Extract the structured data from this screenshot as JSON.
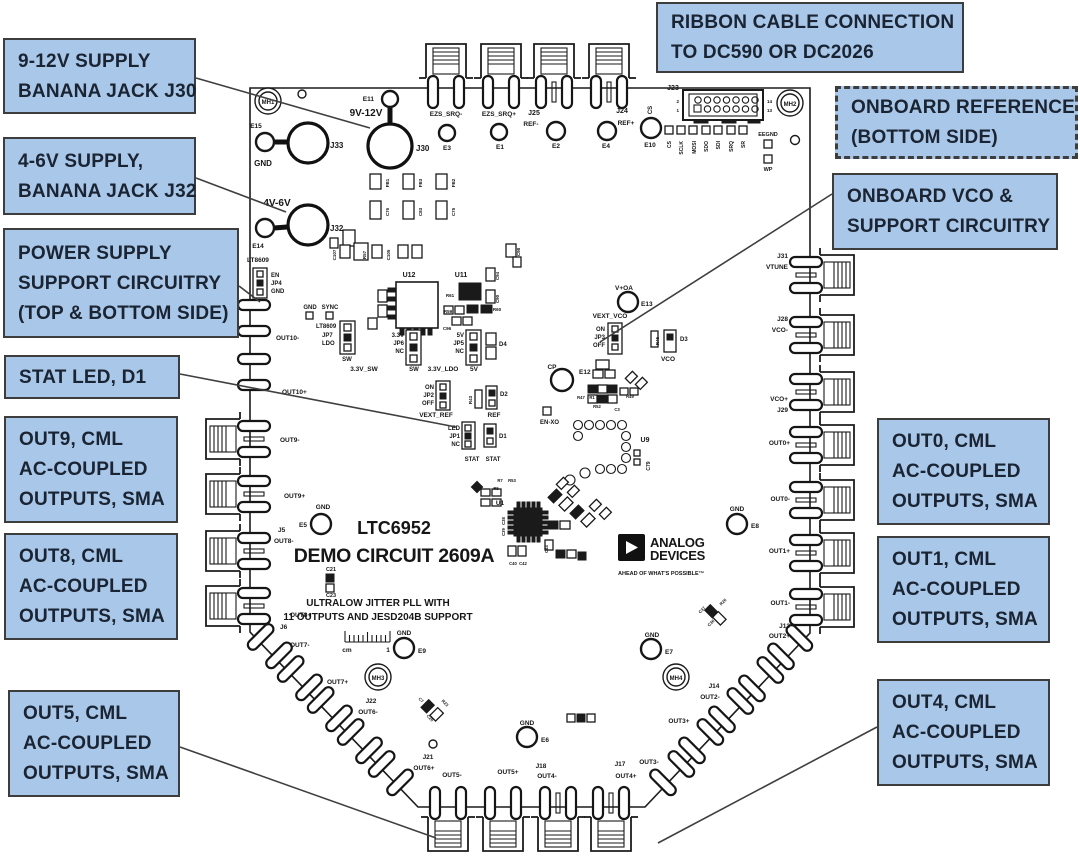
{
  "colors": {
    "callout_fill": "#a9c7e8",
    "callout_border": "#3d3d3d",
    "callout_text": "#1a2433",
    "silkscreen": "#161616"
  },
  "callouts": {
    "supply9": {
      "lines": [
        "9-12V SUPPLY",
        "BANANA JACK J30"
      ]
    },
    "supply4": {
      "lines": [
        "4-6V SUPPLY,",
        "BANANA JACK J32"
      ]
    },
    "psupport": {
      "lines": [
        "POWER SUPPLY",
        "SUPPORT CIRCUITRY",
        "(TOP & BOTTOM SIDE)"
      ]
    },
    "statled": {
      "lines": [
        "STAT LED, D1"
      ]
    },
    "out9": {
      "lines": [
        "OUT9, CML",
        "AC-COUPLED",
        "OUTPUTS, SMA"
      ]
    },
    "out8": {
      "lines": [
        "OUT8, CML",
        "AC-COUPLED",
        "OUTPUTS, SMA"
      ]
    },
    "out5": {
      "lines": [
        "OUT5, CML",
        "AC-COUPLED",
        "OUTPUTS, SMA"
      ]
    },
    "ribbon": {
      "lines": [
        "RIBBON CABLE CONNECTION",
        "TO DC590 OR DC2026"
      ]
    },
    "onref": {
      "lines": [
        "ONBOARD REFERENCE",
        "(BOTTOM SIDE)"
      ]
    },
    "onvco": {
      "lines": [
        "ONBOARD VCO &",
        "SUPPORT CIRCUITRY"
      ]
    },
    "out0": {
      "lines": [
        "OUT0, CML",
        "AC-COUPLED",
        "OUTPUTS, SMA"
      ]
    },
    "out1": {
      "lines": [
        "OUT1, CML",
        "AC-COUPLED",
        "OUTPUTS, SMA"
      ]
    },
    "out4": {
      "lines": [
        "OUT4, CML",
        "AC-COUPLED",
        "OUTPUTS, SMA"
      ]
    }
  },
  "board": {
    "title_line1": "LTC6952",
    "title_line2": "DEMO CIRCUIT 2609A",
    "subtitle_line1": "ULTRALOW JITTER PLL WITH",
    "subtitle_line2": "11 OUTPUTS AND JESD204B SUPPORT",
    "ruler_unit": "cm",
    "ruler_mark": "1",
    "logo": {
      "line1": "ANALOG",
      "line2": "DEVICES",
      "tagline": "AHEAD OF WHAT'S POSSIBLE™"
    },
    "labels": [
      {
        "t": "MH1",
        "x": 268,
        "y": 104,
        "s": 6
      },
      {
        "t": "MH2",
        "x": 790,
        "y": 106,
        "s": 6
      },
      {
        "t": "MH3",
        "x": 378,
        "y": 680,
        "s": 6
      },
      {
        "t": "MH4",
        "x": 676,
        "y": 680,
        "s": 6
      },
      {
        "t": "E15",
        "x": 256,
        "y": 128,
        "s": 6.5
      },
      {
        "t": "GND",
        "x": 263,
        "y": 166,
        "s": 8
      },
      {
        "t": "J33",
        "x": 330,
        "y": 148,
        "s": 8,
        "a": "start"
      },
      {
        "t": "E11",
        "x": 374,
        "y": 101,
        "s": 6.5,
        "a": "end"
      },
      {
        "t": "9V-12V",
        "x": 366,
        "y": 116,
        "s": 10
      },
      {
        "t": "J30",
        "x": 416,
        "y": 151,
        "s": 8,
        "a": "start"
      },
      {
        "t": "4V-6V",
        "x": 277,
        "y": 206,
        "s": 10
      },
      {
        "t": "E14",
        "x": 258,
        "y": 248,
        "s": 6.5
      },
      {
        "t": "J32",
        "x": 330,
        "y": 231,
        "s": 8,
        "a": "start"
      },
      {
        "t": "EZS_SRQ-",
        "x": 446,
        "y": 116,
        "s": 6.5
      },
      {
        "t": "E3",
        "x": 447,
        "y": 150,
        "s": 6.5
      },
      {
        "t": "EZS_SRQ+",
        "x": 499,
        "y": 116,
        "s": 6.5
      },
      {
        "t": "E1",
        "x": 500,
        "y": 149,
        "s": 6.5
      },
      {
        "t": "J25",
        "x": 534,
        "y": 115,
        "s": 7
      },
      {
        "t": "REF-",
        "x": 531,
        "y": 126,
        "s": 6.5
      },
      {
        "t": "E2",
        "x": 556,
        "y": 148,
        "s": 6.5
      },
      {
        "t": "J24",
        "x": 622,
        "y": 113,
        "s": 7
      },
      {
        "t": "REF+",
        "x": 626,
        "y": 125,
        "s": 6.5
      },
      {
        "t": "E4",
        "x": 606,
        "y": 148,
        "s": 6.5
      },
      {
        "t": "CS",
        "x": 652,
        "y": 110,
        "s": 6,
        "r": -90
      },
      {
        "t": "E10",
        "x": 650,
        "y": 147,
        "s": 6.5
      },
      {
        "t": "J23",
        "x": 673,
        "y": 90,
        "s": 7
      },
      {
        "t": "2",
        "x": 679,
        "y": 103,
        "s": 4.5,
        "a": "end"
      },
      {
        "t": "1",
        "x": 679,
        "y": 112,
        "s": 4.5,
        "a": "end"
      },
      {
        "t": "14",
        "x": 767,
        "y": 103,
        "s": 4.5,
        "a": "start"
      },
      {
        "t": "13",
        "x": 767,
        "y": 112,
        "s": 4.5,
        "a": "start"
      },
      {
        "t": "CS",
        "x": 671,
        "y": 141,
        "s": 5,
        "r": -90,
        "a": "end"
      },
      {
        "t": "SCLK",
        "x": 683,
        "y": 141,
        "s": 5,
        "r": -90,
        "a": "end"
      },
      {
        "t": "MOSI",
        "x": 696,
        "y": 141,
        "s": 5,
        "r": -90,
        "a": "end"
      },
      {
        "t": "SDO",
        "x": 708,
        "y": 141,
        "s": 5,
        "r": -90,
        "a": "end"
      },
      {
        "t": "SDI",
        "x": 720,
        "y": 141,
        "s": 5,
        "r": -90,
        "a": "end"
      },
      {
        "t": "SRQ",
        "x": 733,
        "y": 141,
        "s": 5,
        "r": -90,
        "a": "end"
      },
      {
        "t": "SR",
        "x": 745,
        "y": 141,
        "s": 5,
        "r": -90,
        "a": "end"
      },
      {
        "t": "EEGND",
        "x": 768,
        "y": 136,
        "s": 5.5
      },
      {
        "t": "WP",
        "x": 768,
        "y": 171,
        "s": 5.5
      },
      {
        "t": "FB1",
        "x": 389,
        "y": 183,
        "s": 4.5,
        "r": -90
      },
      {
        "t": "C76",
        "x": 389,
        "y": 212,
        "s": 4.5,
        "r": -90
      },
      {
        "t": "FB3",
        "x": 422,
        "y": 183,
        "s": 4.5,
        "r": -90
      },
      {
        "t": "C83",
        "x": 422,
        "y": 212,
        "s": 4.5,
        "r": -90
      },
      {
        "t": "FB2",
        "x": 455,
        "y": 183,
        "s": 4.5,
        "r": -90
      },
      {
        "t": "C75",
        "x": 455,
        "y": 212,
        "s": 4.5,
        "r": -90
      },
      {
        "t": "C107",
        "x": 336,
        "y": 255,
        "s": 4.5,
        "r": -90
      },
      {
        "t": "R57",
        "x": 366,
        "y": 255,
        "s": 4.5,
        "r": -90
      },
      {
        "t": "C105",
        "x": 390,
        "y": 255,
        "s": 4.5,
        "r": -90
      },
      {
        "t": "C98",
        "x": 520,
        "y": 252,
        "s": 4.5,
        "r": -90
      },
      {
        "t": "LT8609",
        "x": 247,
        "y": 262,
        "s": 6.5,
        "a": "start"
      },
      {
        "t": "EN",
        "x": 271,
        "y": 277,
        "s": 6,
        "a": "start"
      },
      {
        "t": "JP4",
        "x": 271,
        "y": 285,
        "s": 6,
        "a": "start"
      },
      {
        "t": "GND",
        "x": 271,
        "y": 293,
        "s": 6,
        "a": "start"
      },
      {
        "t": "GND",
        "x": 310,
        "y": 309,
        "s": 6
      },
      {
        "t": "SYNC",
        "x": 330,
        "y": 309,
        "s": 6
      },
      {
        "t": "U12",
        "x": 409,
        "y": 277,
        "s": 7
      },
      {
        "t": "U11",
        "x": 461,
        "y": 277,
        "s": 7
      },
      {
        "t": "C94",
        "x": 499,
        "y": 276,
        "s": 4.5,
        "r": -90
      },
      {
        "t": "C90",
        "x": 499,
        "y": 299,
        "s": 4.5,
        "r": -90
      },
      {
        "t": "R61",
        "x": 450,
        "y": 297,
        "s": 4.5
      },
      {
        "t": "R59",
        "x": 448,
        "y": 313,
        "s": 4.5
      },
      {
        "t": "R60",
        "x": 497,
        "y": 311,
        "s": 4.5
      },
      {
        "t": "C96",
        "x": 447,
        "y": 330,
        "s": 4.5
      },
      {
        "t": "LT8609",
        "x": 316,
        "y": 328,
        "s": 6,
        "a": "start"
      },
      {
        "t": "JP7",
        "x": 322,
        "y": 337,
        "s": 6,
        "a": "start"
      },
      {
        "t": "LDO",
        "x": 322,
        "y": 345,
        "s": 6,
        "a": "start"
      },
      {
        "t": "SW",
        "x": 347,
        "y": 361,
        "s": 6
      },
      {
        "t": "3.3V_SW",
        "x": 364,
        "y": 371,
        "s": 6.5
      },
      {
        "t": "3.3V",
        "x": 404,
        "y": 337,
        "s": 6,
        "a": "end"
      },
      {
        "t": "JP6",
        "x": 404,
        "y": 345,
        "s": 6,
        "a": "end"
      },
      {
        "t": "NC",
        "x": 404,
        "y": 353,
        "s": 6,
        "a": "end"
      },
      {
        "t": "SW",
        "x": 414,
        "y": 371,
        "s": 6
      },
      {
        "t": "3.3V_LDO",
        "x": 443,
        "y": 371,
        "s": 6.5
      },
      {
        "t": "5V",
        "x": 464,
        "y": 337,
        "s": 6,
        "a": "end"
      },
      {
        "t": "JP5",
        "x": 464,
        "y": 345,
        "s": 6,
        "a": "end"
      },
      {
        "t": "NC",
        "x": 464,
        "y": 353,
        "s": 6,
        "a": "end"
      },
      {
        "t": "5V",
        "x": 474,
        "y": 371,
        "s": 6.5
      },
      {
        "t": "D4",
        "x": 499,
        "y": 346,
        "s": 6,
        "a": "start"
      },
      {
        "t": "ON",
        "x": 434,
        "y": 389,
        "s": 6,
        "a": "end"
      },
      {
        "t": "JP2",
        "x": 434,
        "y": 397,
        "s": 6,
        "a": "end"
      },
      {
        "t": "OFF",
        "x": 434,
        "y": 405,
        "s": 6,
        "a": "end"
      },
      {
        "t": "VEXT_REF",
        "x": 436,
        "y": 417,
        "s": 6.5
      },
      {
        "t": "R43",
        "x": 472,
        "y": 400,
        "s": 4.5,
        "r": -90
      },
      {
        "t": "D2",
        "x": 500,
        "y": 396,
        "s": 6,
        "a": "start"
      },
      {
        "t": "REF",
        "x": 494,
        "y": 417,
        "s": 6.5
      },
      {
        "t": "LED",
        "x": 460,
        "y": 430,
        "s": 6,
        "a": "end"
      },
      {
        "t": "JP1",
        "x": 460,
        "y": 438,
        "s": 6,
        "a": "end"
      },
      {
        "t": "NC",
        "x": 460,
        "y": 446,
        "s": 6,
        "a": "end"
      },
      {
        "t": "D1",
        "x": 499,
        "y": 438,
        "s": 6,
        "a": "start"
      },
      {
        "t": "STAT",
        "x": 472,
        "y": 461,
        "s": 6
      },
      {
        "t": "STAT",
        "x": 493,
        "y": 461,
        "s": 6
      },
      {
        "t": "V+OA",
        "x": 624,
        "y": 290,
        "s": 6.5
      },
      {
        "t": "E13",
        "x": 641,
        "y": 306,
        "s": 6.5,
        "a": "start"
      },
      {
        "t": "VEXT_VCO",
        "x": 610,
        "y": 318,
        "s": 6.5
      },
      {
        "t": "ON",
        "x": 605,
        "y": 331,
        "s": 6,
        "a": "end"
      },
      {
        "t": "JP3",
        "x": 605,
        "y": 339,
        "s": 6,
        "a": "end"
      },
      {
        "t": "OFF",
        "x": 605,
        "y": 347,
        "s": 6,
        "a": "end"
      },
      {
        "t": "R45",
        "x": 659,
        "y": 341,
        "s": 4.5,
        "r": -90
      },
      {
        "t": "D3",
        "x": 680,
        "y": 341,
        "s": 6,
        "a": "start"
      },
      {
        "t": "VCO",
        "x": 668,
        "y": 361,
        "s": 6.5
      },
      {
        "t": "CP",
        "x": 552,
        "y": 369,
        "s": 6.5
      },
      {
        "t": "E12",
        "x": 579,
        "y": 374,
        "s": 6.5,
        "a": "start"
      },
      {
        "t": "R47",
        "x": 581,
        "y": 399,
        "s": 4.2
      },
      {
        "t": "R1",
        "x": 592,
        "y": 399,
        "s": 4.2
      },
      {
        "t": "R51",
        "x": 603,
        "y": 399,
        "s": 4.2
      },
      {
        "t": "R52",
        "x": 597,
        "y": 408,
        "s": 4.2
      },
      {
        "t": "C3",
        "x": 617,
        "y": 411,
        "s": 4.2
      },
      {
        "t": "R49",
        "x": 630,
        "y": 398,
        "s": 4.2
      },
      {
        "t": "EN-XO",
        "x": 540,
        "y": 424,
        "s": 6,
        "a": "start"
      },
      {
        "t": "U9",
        "x": 645,
        "y": 442,
        "s": 7
      },
      {
        "t": "C79",
        "x": 650,
        "y": 466,
        "s": 5,
        "r": -90
      },
      {
        "t": "R7",
        "x": 500,
        "y": 482,
        "s": 4.2
      },
      {
        "t": "R53",
        "x": 512,
        "y": 482,
        "s": 4.2
      },
      {
        "t": "R5",
        "x": 496,
        "y": 490,
        "s": 4.2
      },
      {
        "t": "U1",
        "x": 500,
        "y": 505,
        "s": 6.5
      },
      {
        "t": "C38",
        "x": 505,
        "y": 521,
        "s": 4.2,
        "r": -90
      },
      {
        "t": "C39",
        "x": 505,
        "y": 532,
        "s": 4.2,
        "r": -90
      },
      {
        "t": "C40",
        "x": 513,
        "y": 565,
        "s": 4.2
      },
      {
        "t": "C42",
        "x": 523,
        "y": 565,
        "s": 4.2
      },
      {
        "t": "C44",
        "x": 548,
        "y": 549,
        "s": 4.2,
        "r": -90
      },
      {
        "t": "GND",
        "x": 323,
        "y": 509,
        "s": 6.5
      },
      {
        "t": "E5",
        "x": 307,
        "y": 527,
        "s": 6.5,
        "a": "end"
      },
      {
        "t": "C21",
        "x": 331,
        "y": 571,
        "s": 5.5
      },
      {
        "t": "C23",
        "x": 331,
        "y": 597,
        "s": 5.5
      },
      {
        "t": "GND",
        "x": 404,
        "y": 635,
        "s": 6.5
      },
      {
        "t": "E9",
        "x": 418,
        "y": 653,
        "s": 6.5,
        "a": "start"
      },
      {
        "t": "GND",
        "x": 652,
        "y": 637,
        "s": 6.5
      },
      {
        "t": "E7",
        "x": 665,
        "y": 654,
        "s": 6.5,
        "a": "start"
      },
      {
        "t": "GND",
        "x": 527,
        "y": 725,
        "s": 6.5
      },
      {
        "t": "E6",
        "x": 541,
        "y": 742,
        "s": 6.5,
        "a": "start"
      },
      {
        "t": "GND",
        "x": 737,
        "y": 511,
        "s": 6.5
      },
      {
        "t": "E8",
        "x": 751,
        "y": 528,
        "s": 6.5,
        "a": "start"
      },
      {
        "t": "C36",
        "x": 712,
        "y": 624,
        "s": 4.2,
        "r": -45
      },
      {
        "t": "R26",
        "x": 724,
        "y": 603,
        "s": 4.2,
        "r": -45
      },
      {
        "t": "C37",
        "x": 703,
        "y": 611,
        "s": 4.2,
        "r": -45
      },
      {
        "t": "C7",
        "x": 420,
        "y": 701,
        "s": 4.2,
        "r": 45
      },
      {
        "t": "C28",
        "x": 429,
        "y": 719,
        "s": 4.2,
        "r": 45
      },
      {
        "t": "R23",
        "x": 444,
        "y": 704,
        "s": 4.2,
        "r": 45
      },
      {
        "t": "OUT10-",
        "x": 276,
        "y": 340,
        "s": 6.5,
        "a": "start"
      },
      {
        "t": "OUT10+",
        "x": 282,
        "y": 394,
        "s": 6.5,
        "a": "start"
      },
      {
        "t": "OUT9-",
        "x": 280,
        "y": 442,
        "s": 6.5,
        "a": "start"
      },
      {
        "t": "OUT9+",
        "x": 284,
        "y": 498,
        "s": 6.5,
        "a": "start"
      },
      {
        "t": "J5",
        "x": 278,
        "y": 532,
        "s": 6.5,
        "a": "start"
      },
      {
        "t": "OUT8-",
        "x": 274,
        "y": 543,
        "s": 6.5,
        "a": "start"
      },
      {
        "t": "OUT8+",
        "x": 290,
        "y": 617,
        "s": 6.5,
        "a": "start"
      },
      {
        "t": "J6",
        "x": 280,
        "y": 629,
        "s": 6.5,
        "a": "start"
      },
      {
        "t": "OUT7-",
        "x": 290,
        "y": 647,
        "s": 6.5,
        "a": "start"
      },
      {
        "t": "OUT7+",
        "x": 327,
        "y": 684,
        "s": 6.5,
        "a": "start"
      },
      {
        "t": "J22",
        "x": 371,
        "y": 703,
        "s": 6.5
      },
      {
        "t": "OUT6-",
        "x": 368,
        "y": 714,
        "s": 6.5
      },
      {
        "t": "J21",
        "x": 428,
        "y": 759,
        "s": 6.5
      },
      {
        "t": "OUT6+",
        "x": 424,
        "y": 770,
        "s": 6.5
      },
      {
        "t": "OUT5-",
        "x": 452,
        "y": 777,
        "s": 6.5
      },
      {
        "t": "OUT5+",
        "x": 508,
        "y": 774,
        "s": 6.5
      },
      {
        "t": "J18",
        "x": 541,
        "y": 768,
        "s": 6.5
      },
      {
        "t": "OUT4-",
        "x": 547,
        "y": 778,
        "s": 6.5
      },
      {
        "t": "J17",
        "x": 620,
        "y": 766,
        "s": 6.5
      },
      {
        "t": "OUT4+",
        "x": 626,
        "y": 778,
        "s": 6.5
      },
      {
        "t": "OUT3-",
        "x": 649,
        "y": 764,
        "s": 6.5
      },
      {
        "t": "OUT3+",
        "x": 679,
        "y": 723,
        "s": 6.5
      },
      {
        "t": "J14",
        "x": 714,
        "y": 688,
        "s": 6.5
      },
      {
        "t": "OUT2-",
        "x": 710,
        "y": 699,
        "s": 6.5
      },
      {
        "t": "J31",
        "x": 788,
        "y": 258,
        "s": 6.5,
        "a": "end"
      },
      {
        "t": "VTUNE",
        "x": 788,
        "y": 269,
        "s": 6.5,
        "a": "end"
      },
      {
        "t": "J28",
        "x": 788,
        "y": 321,
        "s": 6.5,
        "a": "end"
      },
      {
        "t": "VCO-",
        "x": 788,
        "y": 332,
        "s": 6.5,
        "a": "end"
      },
      {
        "t": "VCO+",
        "x": 788,
        "y": 401,
        "s": 6.5,
        "a": "end"
      },
      {
        "t": "J29",
        "x": 788,
        "y": 412,
        "s": 6.5,
        "a": "end"
      },
      {
        "t": "OUT0+",
        "x": 790,
        "y": 445,
        "s": 6.5,
        "a": "end"
      },
      {
        "t": "OUT0-",
        "x": 790,
        "y": 501,
        "s": 6.5,
        "a": "end"
      },
      {
        "t": "OUT1+",
        "x": 790,
        "y": 553,
        "s": 6.5,
        "a": "end"
      },
      {
        "t": "OUT1-",
        "x": 790,
        "y": 605,
        "s": 6.5,
        "a": "end"
      },
      {
        "t": "J13",
        "x": 790,
        "y": 628,
        "s": 6.5,
        "a": "end"
      },
      {
        "t": "OUT2+",
        "x": 790,
        "y": 638,
        "s": 6.5,
        "a": "end"
      }
    ]
  }
}
